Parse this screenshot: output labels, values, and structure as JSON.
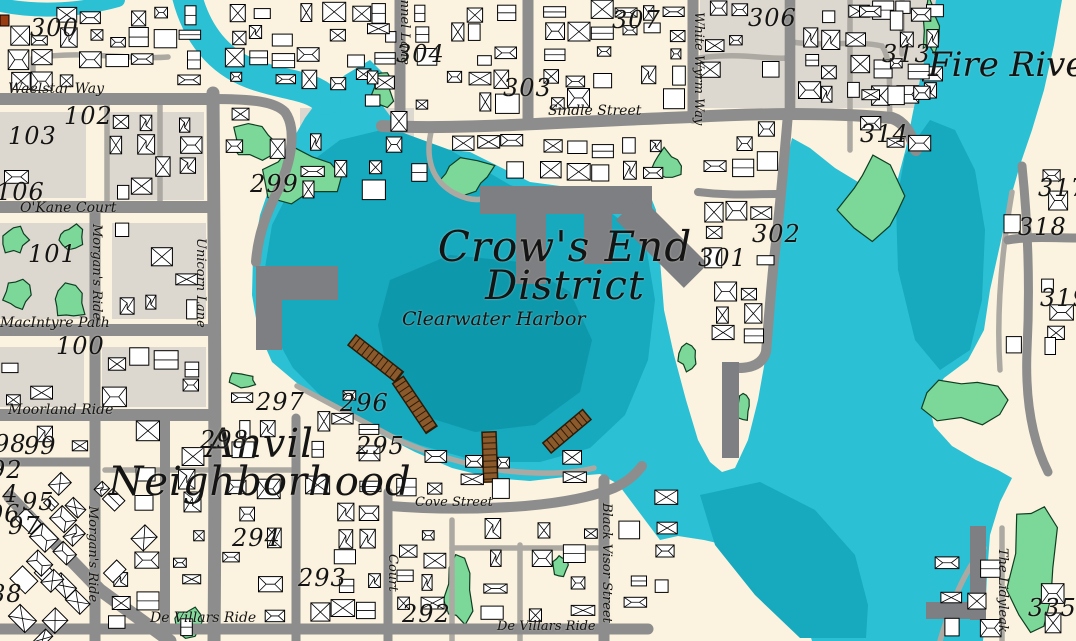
{
  "labels": {
    "district_line1": "Crow's End",
    "district_line2": "District",
    "harbor": "Clearwater Harbor",
    "neighborhood_line1": "Anvil",
    "neighborhood_line2": "Neighborhood",
    "river": "Fire River"
  },
  "streets": {
    "waelstar": "Waelstar Way",
    "okane": "O'Kane Court",
    "macintyre": "MacIntyre Path",
    "moorland": "Moorland Ride",
    "morgans": "Morgan's Ride",
    "unicorn": "Unicorn Lane",
    "lynnel": "Lynnel Lane",
    "whitewyrm": "White Wyrm Way",
    "sindle": "Sindle Street",
    "cove": "Cove Street",
    "devillars": "De Villars Ride",
    "blackvisor": "Black Visor Street",
    "court": "Court",
    "lidyleak": "The Lidyleak"
  },
  "blocks": {
    "n300": "300",
    "n304": "304",
    "n303": "303",
    "n307": "307",
    "n306": "306",
    "n313": "313",
    "n314": "314",
    "n317": "317",
    "n318": "318",
    "n319": "319",
    "n302": "302",
    "n301": "301",
    "n299": "299",
    "n102": "102",
    "n103": "103",
    "n106": "106",
    "n101": "101",
    "n100": "100",
    "n98": "98",
    "n99": "99",
    "n92": "92",
    "n94": "94",
    "n95": "95",
    "n96": "96",
    "n97": "97",
    "n88": "88",
    "n297": "297",
    "n296": "296",
    "n298": "298",
    "n295": "295",
    "n294": "294",
    "n293": "293",
    "n292": "292",
    "n335": "335"
  },
  "colors": {
    "water": "#2BC0D4",
    "waterMid": "#17A9BE",
    "waterDark": "#0E98AC",
    "land": "#FBF3DF",
    "blockGray": "#DCD7CF",
    "road": "#8D8D8D",
    "roadMinor": "#ACA9A2",
    "park": "#7CD898",
    "parkStroke": "#0F3D22",
    "pier": "#8A5A2C",
    "pierDark": "#2E1A05",
    "dock": "#7E7F82",
    "building": "#FFFFFF",
    "outline": "#000000",
    "marker": "#993C12"
  }
}
